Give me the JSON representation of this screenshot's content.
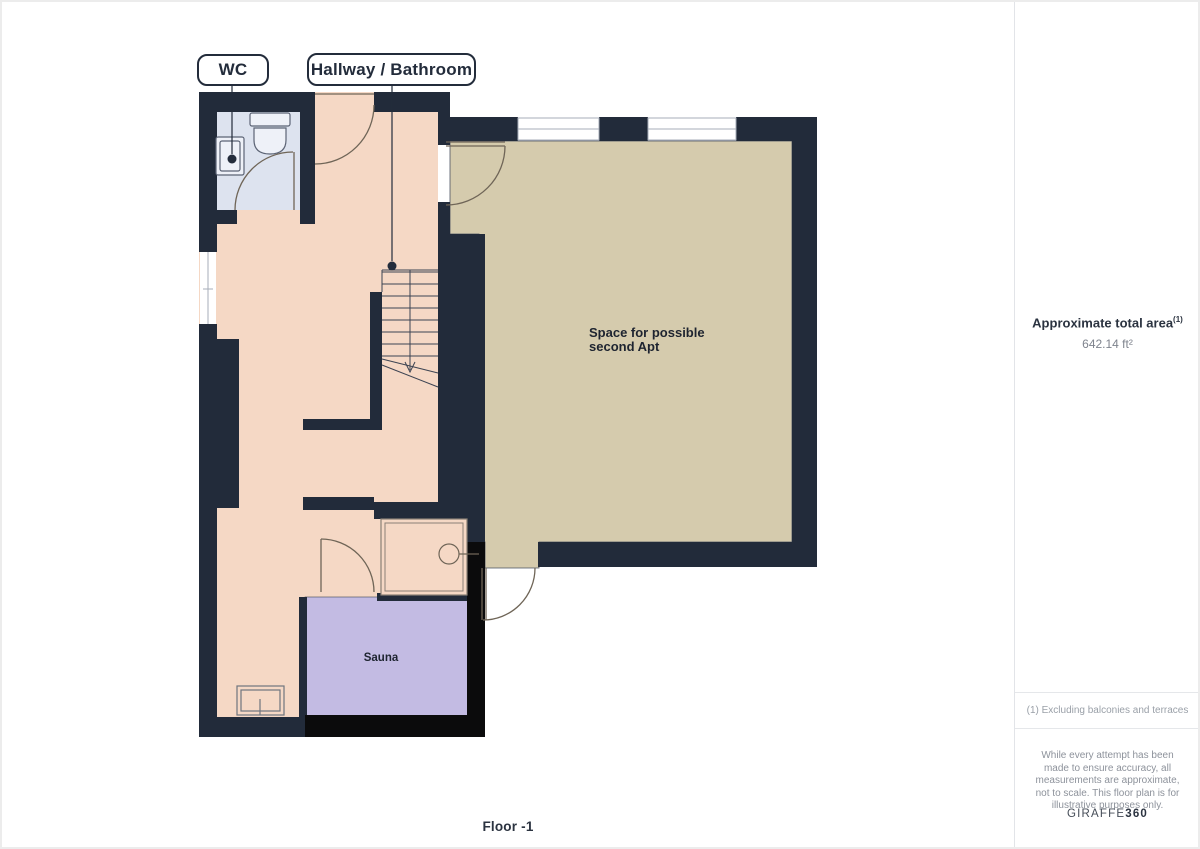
{
  "plan": {
    "room_labels": {
      "wc": "WC",
      "hallway_bathroom": "Hallway / Bathroom",
      "space": "Space for possible second Apt",
      "sauna": "Sauna"
    },
    "floor_label": "Floor -1"
  },
  "sidebar": {
    "area": {
      "title": "Approximate total area",
      "superscript": "(1)",
      "value": "642.14 ft²"
    },
    "footnote": "(1) Excluding balconies and terraces",
    "disclaimer": "While every attempt has been made to ensure accuracy, all measurements are approximate, not to scale. This floor plan is for illustrative purposes only.",
    "brand": {
      "name": "GIRAFFE",
      "suffix": "360"
    }
  },
  "colors": {
    "wall": "#222b3a",
    "sauna_wall": "#0b0b0c",
    "hallway_floor": "#f5d8c5",
    "wc_floor": "#dde3ef",
    "room_floor": "#d5cbad",
    "sauna_floor": "#c3bbe3",
    "shower_floor": "#f5d8c5",
    "door_line": "#6f6557",
    "fixture_line": "#5c6475",
    "stair_line": "#3c4352"
  }
}
